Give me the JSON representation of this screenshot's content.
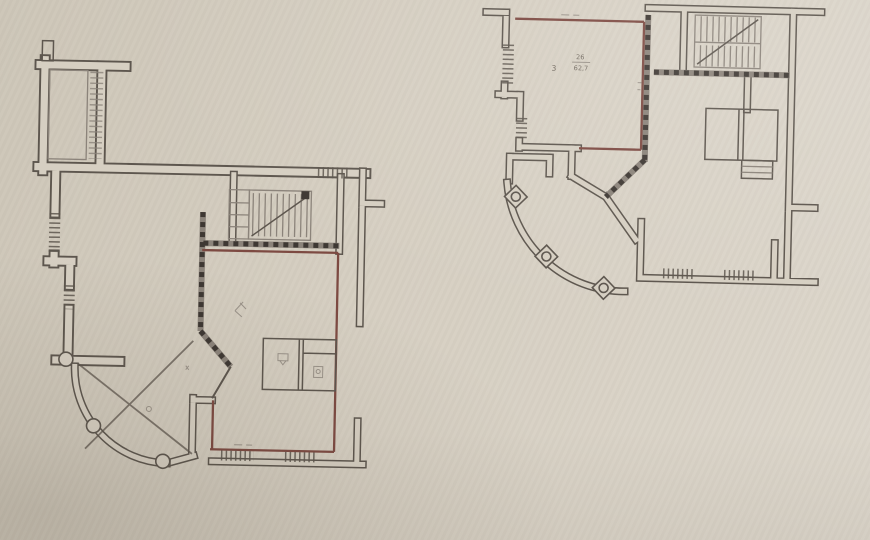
{
  "colors": {
    "paper": "#d6cfc2",
    "paper_light": "#ded9ce",
    "ink": "#5d564e",
    "ink_light": "#8b837a",
    "wall_red": "#7d4a42",
    "checker_dark": "#3e3833",
    "label": "#655d53"
  },
  "plan_right": {
    "room_number": "26",
    "room_area": "62,7",
    "room_index": "3"
  }
}
